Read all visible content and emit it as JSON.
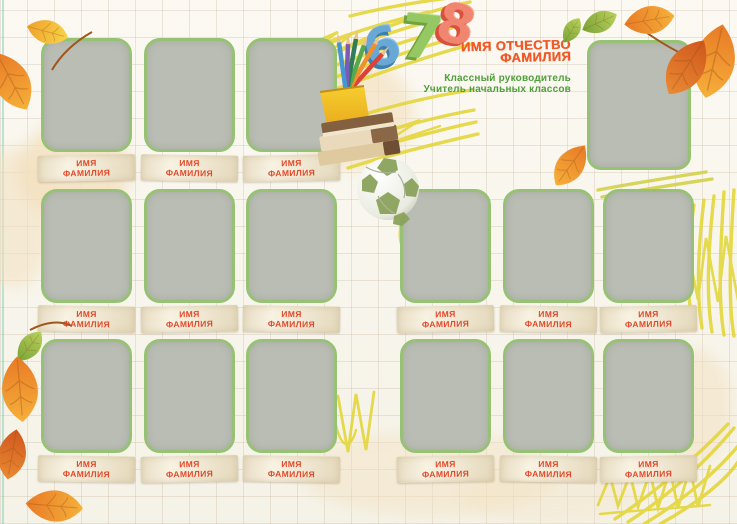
{
  "header": {
    "class_numbers": [
      "6",
      "7",
      "8"
    ],
    "teacher_title_line1": "ИМЯ ОТЧЕСТВО",
    "teacher_title_line2": "ФАМИЛИЯ",
    "teacher_subtitle_line1": "Классный руководитель",
    "teacher_subtitle_line2": "Учитель начальных классов"
  },
  "student_label": {
    "line1": "ИМЯ",
    "line2": "ФАМИЛИЯ"
  },
  "layout_counts": {
    "student_photo_slots": 15,
    "teacher_photo_slots": 1
  },
  "decorations": {
    "icons": [
      "autumn-leaf-icon",
      "pencil-cup-icon",
      "book-stack-icon",
      "soccer-ball-icon",
      "crayon-scribble-icon",
      "grid-paper-background"
    ]
  },
  "colors": {
    "background": "#f9f7f0",
    "grid_line": "#d9cdbc",
    "frame_border": "#97c175",
    "frame_fill": "#b9bdb4",
    "nameplate_bg": "#f2ead6",
    "accent_orange": "#e2492a",
    "title_orange": "#f05a28",
    "subtitle_green": "#4f9f3b",
    "number_blue": "#69a7d4",
    "number_green": "#95c763",
    "number_red": "#f08570",
    "scribble_yellow": "#e4d63b",
    "leaf_orange": "#f0923c",
    "leaf_green": "#8ab544"
  }
}
